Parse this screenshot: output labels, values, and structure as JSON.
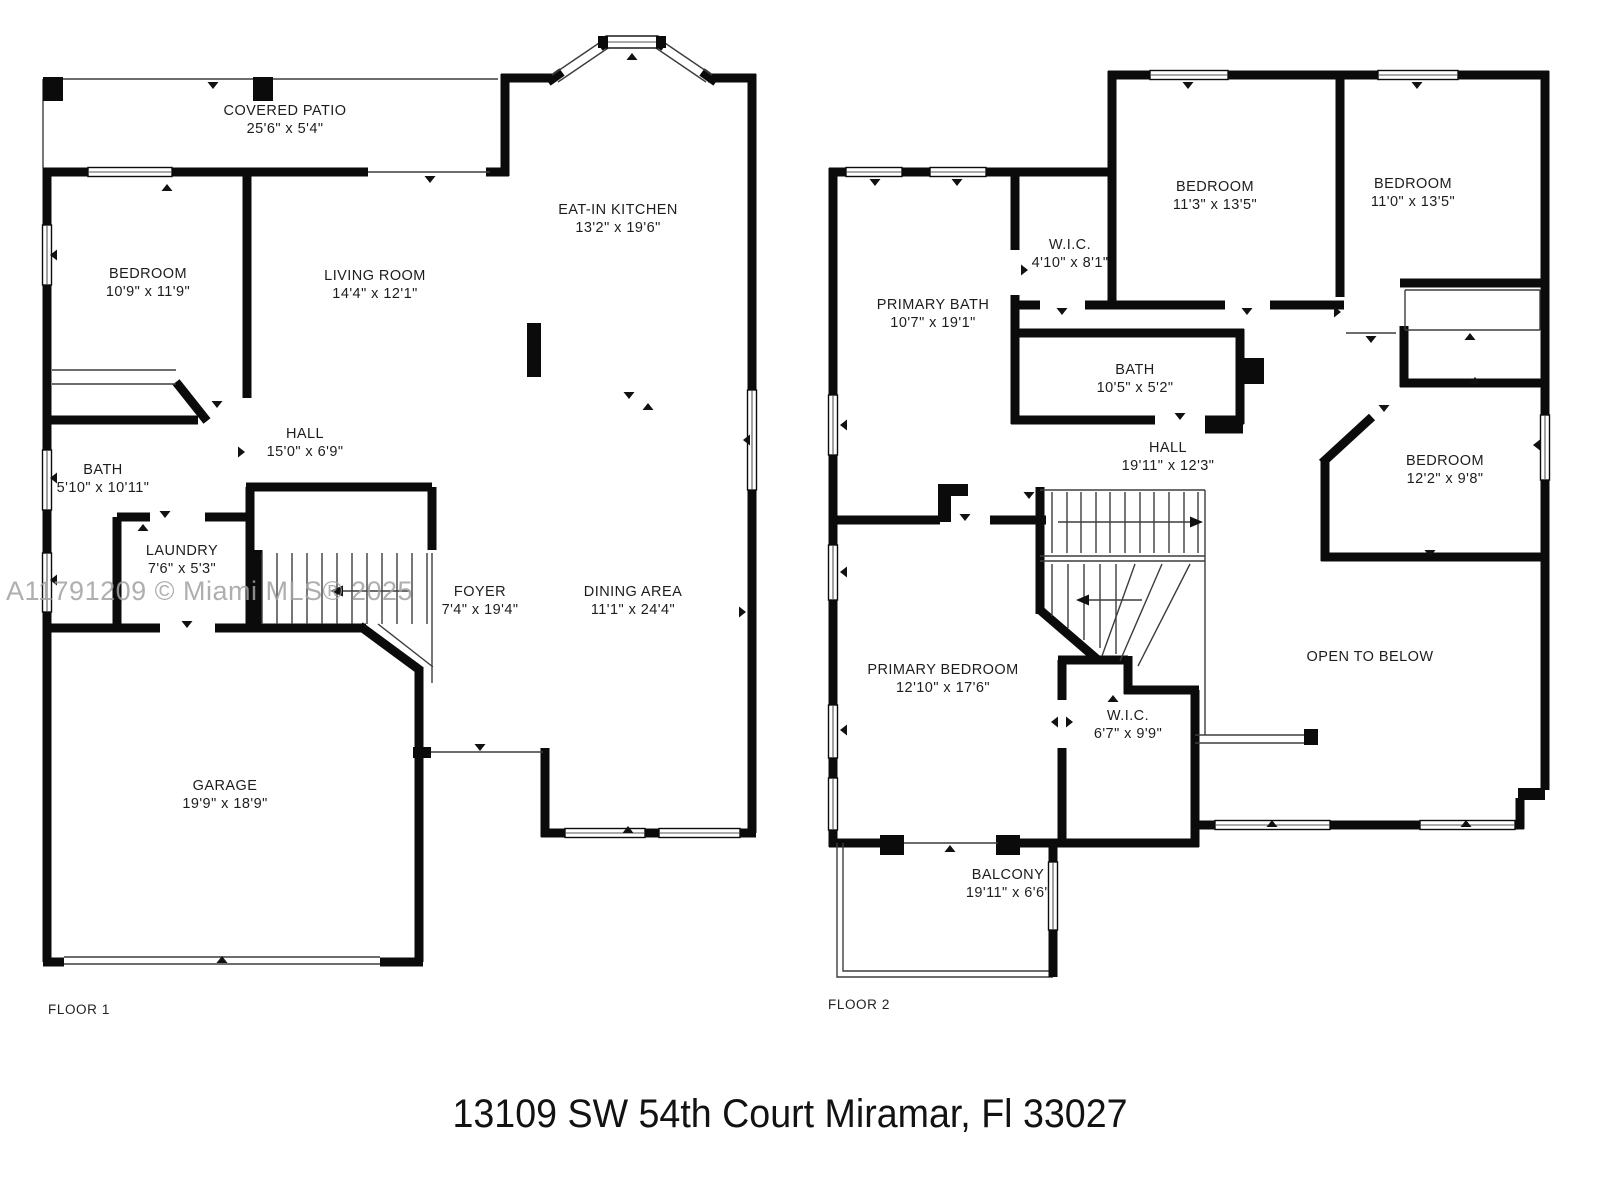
{
  "watermark": "A11791209 © Miami MLS® 2025",
  "address": "13109 SW 54th Court Miramar, Fl 33027",
  "floor1": {
    "caption": "FLOOR 1",
    "rooms": [
      {
        "name": "COVERED PATIO",
        "dims": "25'6\" x 5'4\""
      },
      {
        "name": "BEDROOM",
        "dims": "10'9\" x 11'9\""
      },
      {
        "name": "LIVING ROOM",
        "dims": "14'4\" x 12'1\""
      },
      {
        "name": "EAT-IN KITCHEN",
        "dims": "13'2\" x 19'6\""
      },
      {
        "name": "HALL",
        "dims": "15'0\" x 6'9\""
      },
      {
        "name": "BATH",
        "dims": "5'10\" x 10'11\""
      },
      {
        "name": "LAUNDRY",
        "dims": "7'6\" x 5'3\""
      },
      {
        "name": "FOYER",
        "dims": "7'4\" x 19'4\""
      },
      {
        "name": "DINING AREA",
        "dims": "11'1\" x 24'4\""
      },
      {
        "name": "GARAGE",
        "dims": "19'9\" x 18'9\""
      }
    ]
  },
  "floor2": {
    "caption": "FLOOR 2",
    "rooms": [
      {
        "name": "BEDROOM",
        "dims": "11'3\" x 13'5\""
      },
      {
        "name": "BEDROOM",
        "dims": "11'0\" x 13'5\""
      },
      {
        "name": "W.I.C.",
        "dims": "4'10\" x 8'1\""
      },
      {
        "name": "PRIMARY BATH",
        "dims": "10'7\" x 19'1\""
      },
      {
        "name": "BATH",
        "dims": "10'5\" x 5'2\""
      },
      {
        "name": "HALL",
        "dims": "19'11\" x 12'3\""
      },
      {
        "name": "BEDROOM",
        "dims": "12'2\" x 9'8\""
      },
      {
        "name": "PRIMARY BEDROOM",
        "dims": "12'10\" x 17'6\""
      },
      {
        "name": "W.I.C.",
        "dims": "6'7\" x 9'9\""
      },
      {
        "name": "OPEN TO BELOW",
        "dims": ""
      },
      {
        "name": "BALCONY",
        "dims": "19'11\" x 6'6\""
      }
    ]
  }
}
